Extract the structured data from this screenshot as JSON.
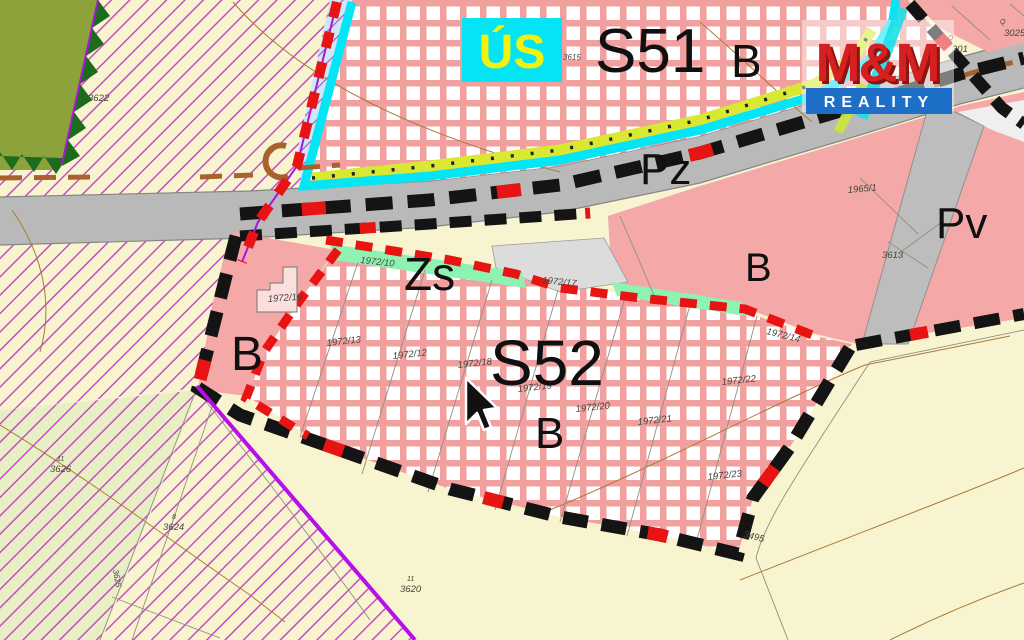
{
  "map_title": "Územní plán / katastrální mapa výřez",
  "zone_labels": {
    "us_overlay": "ÚS",
    "s51": "S51",
    "b_s51": "B",
    "pz": "Pz",
    "pv": "Pv",
    "b_right": "B",
    "zs": "Zs",
    "s52": "S52",
    "b_s52": "B",
    "b_left": "B"
  },
  "parcels": {
    "p3622": "3622",
    "p3615": "3615",
    "p1965_1": "1965/1",
    "p3613": "3613",
    "p301": "301",
    "p301_sym": "Q",
    "p3025": "3025",
    "p3025_sym": "Q",
    "p1972_10": "1972/10",
    "p1972_17": "1972/17",
    "p1972_14": "1972/14",
    "p1972_16": "1972/16",
    "p1972_13": "1972/13",
    "p1972_12": "1972/12",
    "p1972_18": "1972/18",
    "p1972_19": "1972/19",
    "p1972_20": "1972/20",
    "p1972_21": "1972/21",
    "p1972_22": "1972/22",
    "p1972_23": "1972/23",
    "p3626": "3626",
    "p3626_sup": "11",
    "p3624": "3624",
    "p3624_sup": "8",
    "p3625": "3625",
    "p3620": "3620",
    "p3620_sup": "11",
    "p3495": "3495"
  },
  "logo": {
    "name": "M&M",
    "subtitle": "REALITY"
  },
  "colors": {
    "grid_pink": "#f19f9f",
    "solid_pink": "#f5a8a8",
    "road_gray": "#b9b9b9",
    "light_gray": "#dcdcdc",
    "cyan_border": "#04e6f6",
    "chartreuse_band": "#d9e830",
    "mint_green": "#8df2b2",
    "forest_olive": "#8ba33a",
    "forest_dark": "#1d6b1d",
    "hatch_magenta": "#c44fc0",
    "purple_line": "#a816d8",
    "red_dash": "#e81414",
    "black_dash": "#141414",
    "brown_line": "#a8622e",
    "cream": "#f8f4d0",
    "pale_green": "#e9efc5",
    "blue_strip": "#cde7f6",
    "logo_red": "#cf1d1d",
    "logo_blue": "#1e6fc8",
    "badge_cyan": "#04e4f4",
    "badge_yellow": "#f2f20a"
  }
}
